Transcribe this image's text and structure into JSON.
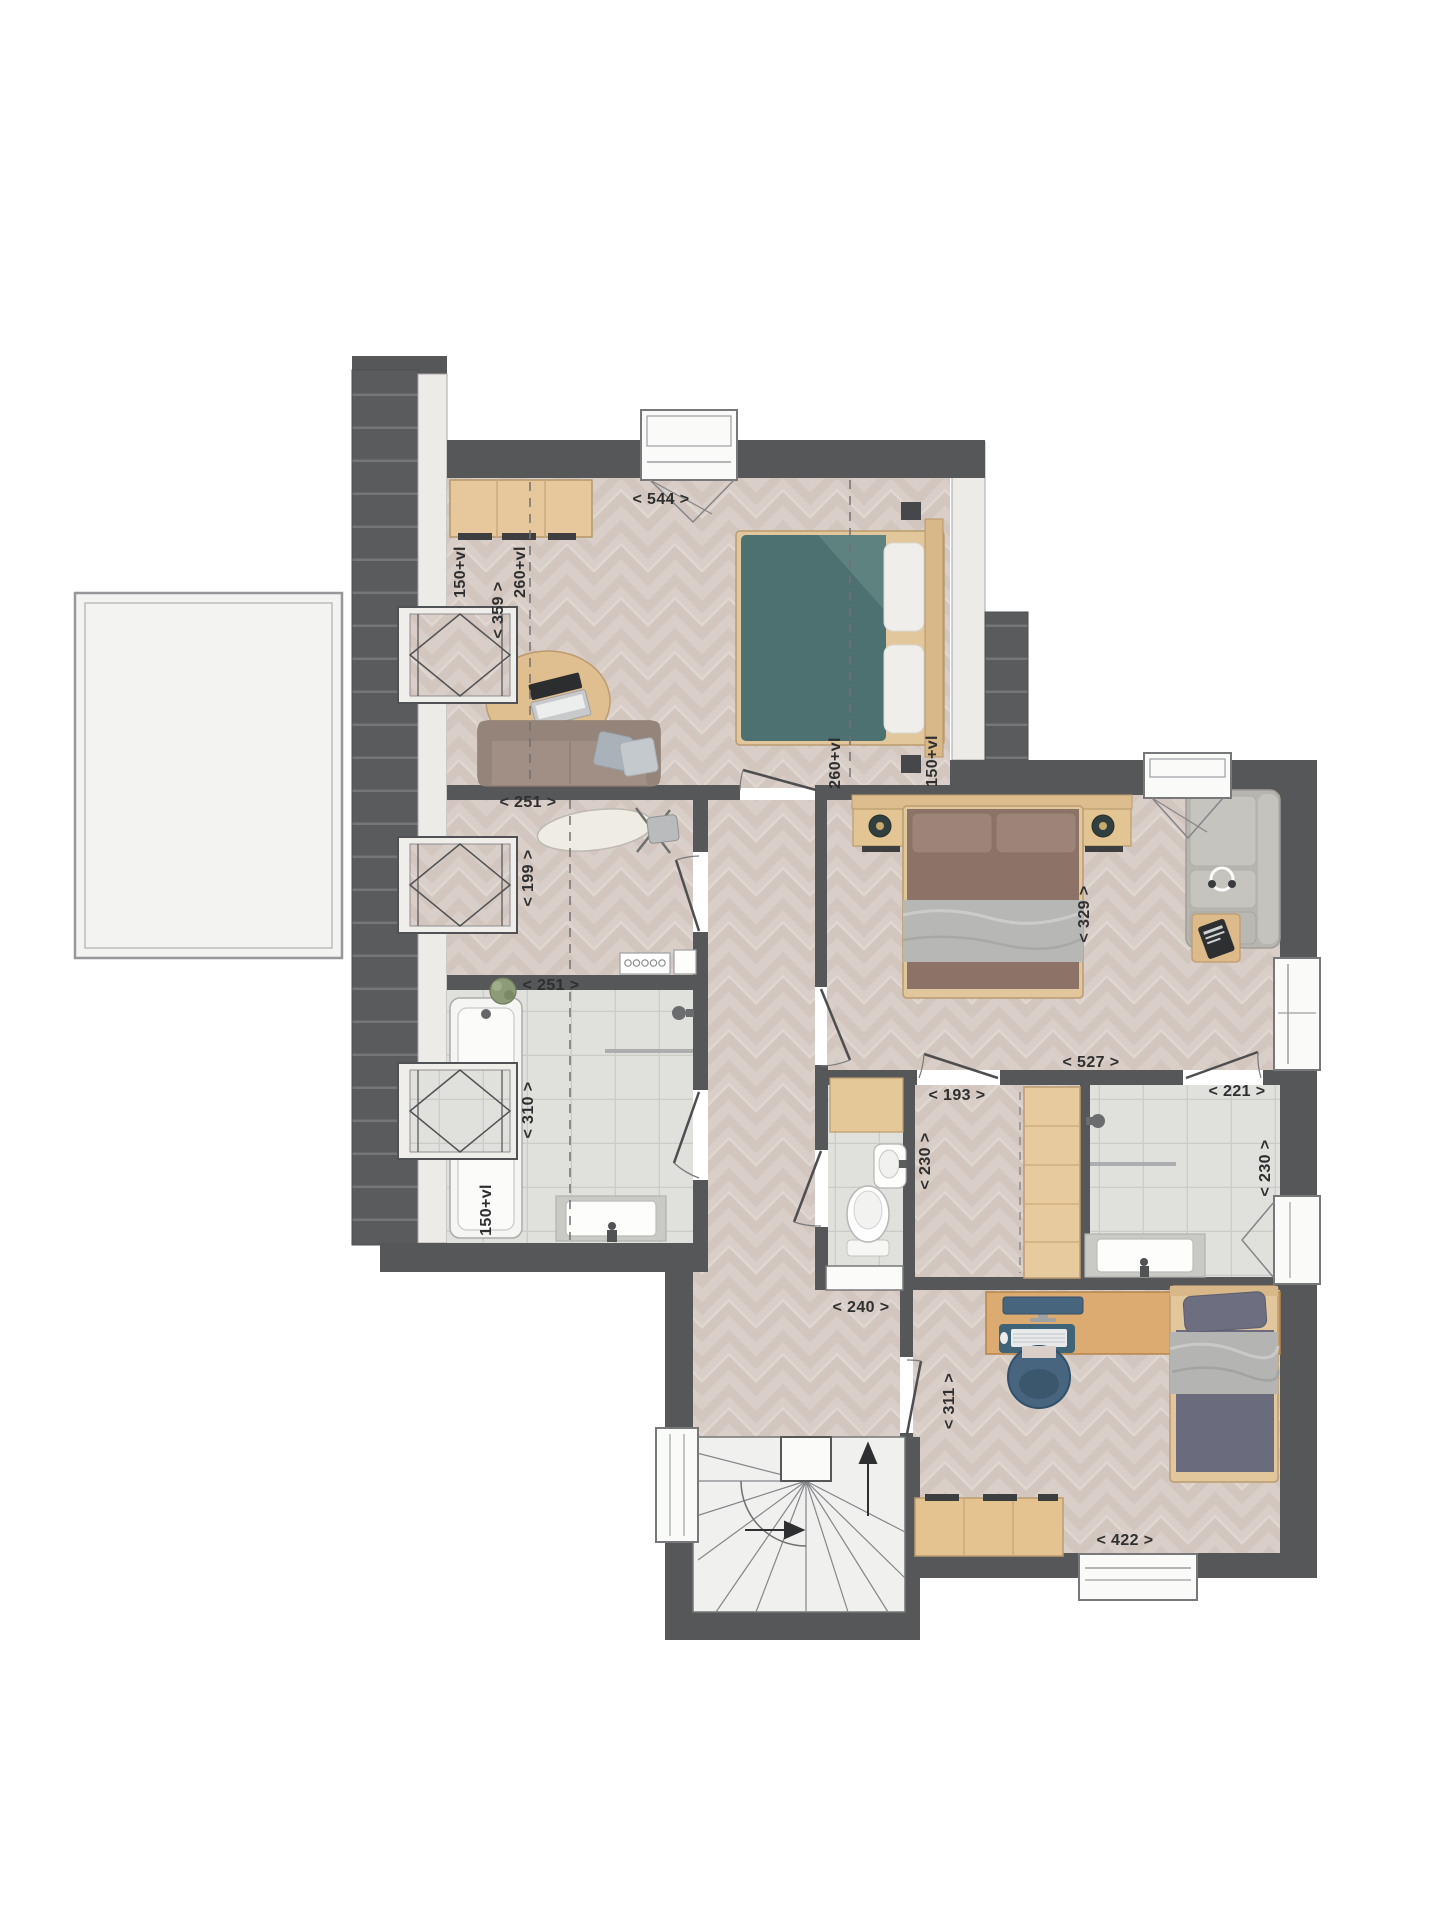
{
  "labels": {
    "bedroom1_width": "< 544 >",
    "bedroom1_left_knee": "150+vl",
    "bedroom1_left_ridge": "260+vl",
    "bedroom1_depth": "< 359 >",
    "bedroom1_right_ridge": "260+vl",
    "bedroom1_right_knee": "150+vl",
    "laundry_width": "< 251 >",
    "laundry_depth": "< 199 >",
    "bath1_width": "< 251 >",
    "bath1_depth": "< 310 >",
    "bath1_knee": "150+vl",
    "master_width": "< 527 >",
    "master_depth": "< 329 >",
    "closet_width": "< 193 >",
    "closet_depth": "< 230 >",
    "bath2_width": "< 221 >",
    "bath2_depth": "< 230 >",
    "hall_width": "< 240 >",
    "bedroom3_depth": "< 311 >",
    "bedroom3_width": "< 422 >"
  }
}
